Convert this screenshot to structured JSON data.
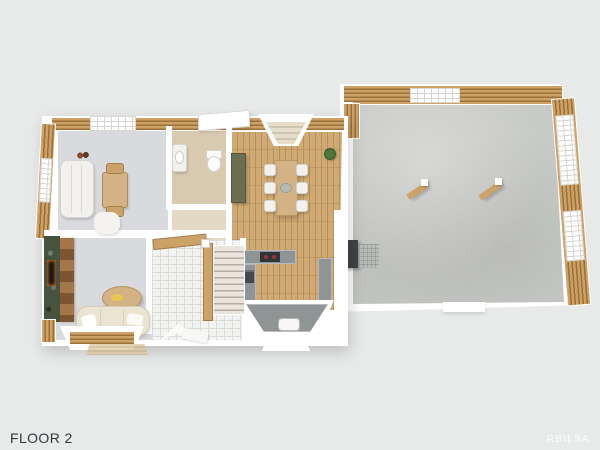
{
  "viewer": {
    "floor_label": "FLOOR 2",
    "watermark": "RBILSA"
  },
  "colors": {
    "background": "#e8eaea",
    "label": "#33383d",
    "watermark_color": "rgba(255,255,255,0.65)",
    "wall": "#ffffff",
    "wood_light": "#cda267",
    "wood_gap": "#9c7038",
    "wood_floor_a": "#cda56c",
    "carpet": "#d9dade",
    "tile": "#f3f3f1",
    "tile_line": "#dcdcd6",
    "beige": "#d9cbb2",
    "beige_light": "#e3d9c5",
    "concrete_a": "#c8cac7",
    "counter": "#8f9595",
    "cooktop": "#2f3436",
    "burner": "#a03238",
    "fireplace": "#46543f",
    "mantel_a": "#a5764a",
    "mantel_b": "#7e5531",
    "sofa_white": "#f3f1ed",
    "sofa_beige": "#ebe4d2",
    "table_wood": "#d3b286",
    "cabinet_olive": "#6b6f52",
    "plant_green": "#4d7a3c",
    "appliance_dark": "#3f4346"
  }
}
